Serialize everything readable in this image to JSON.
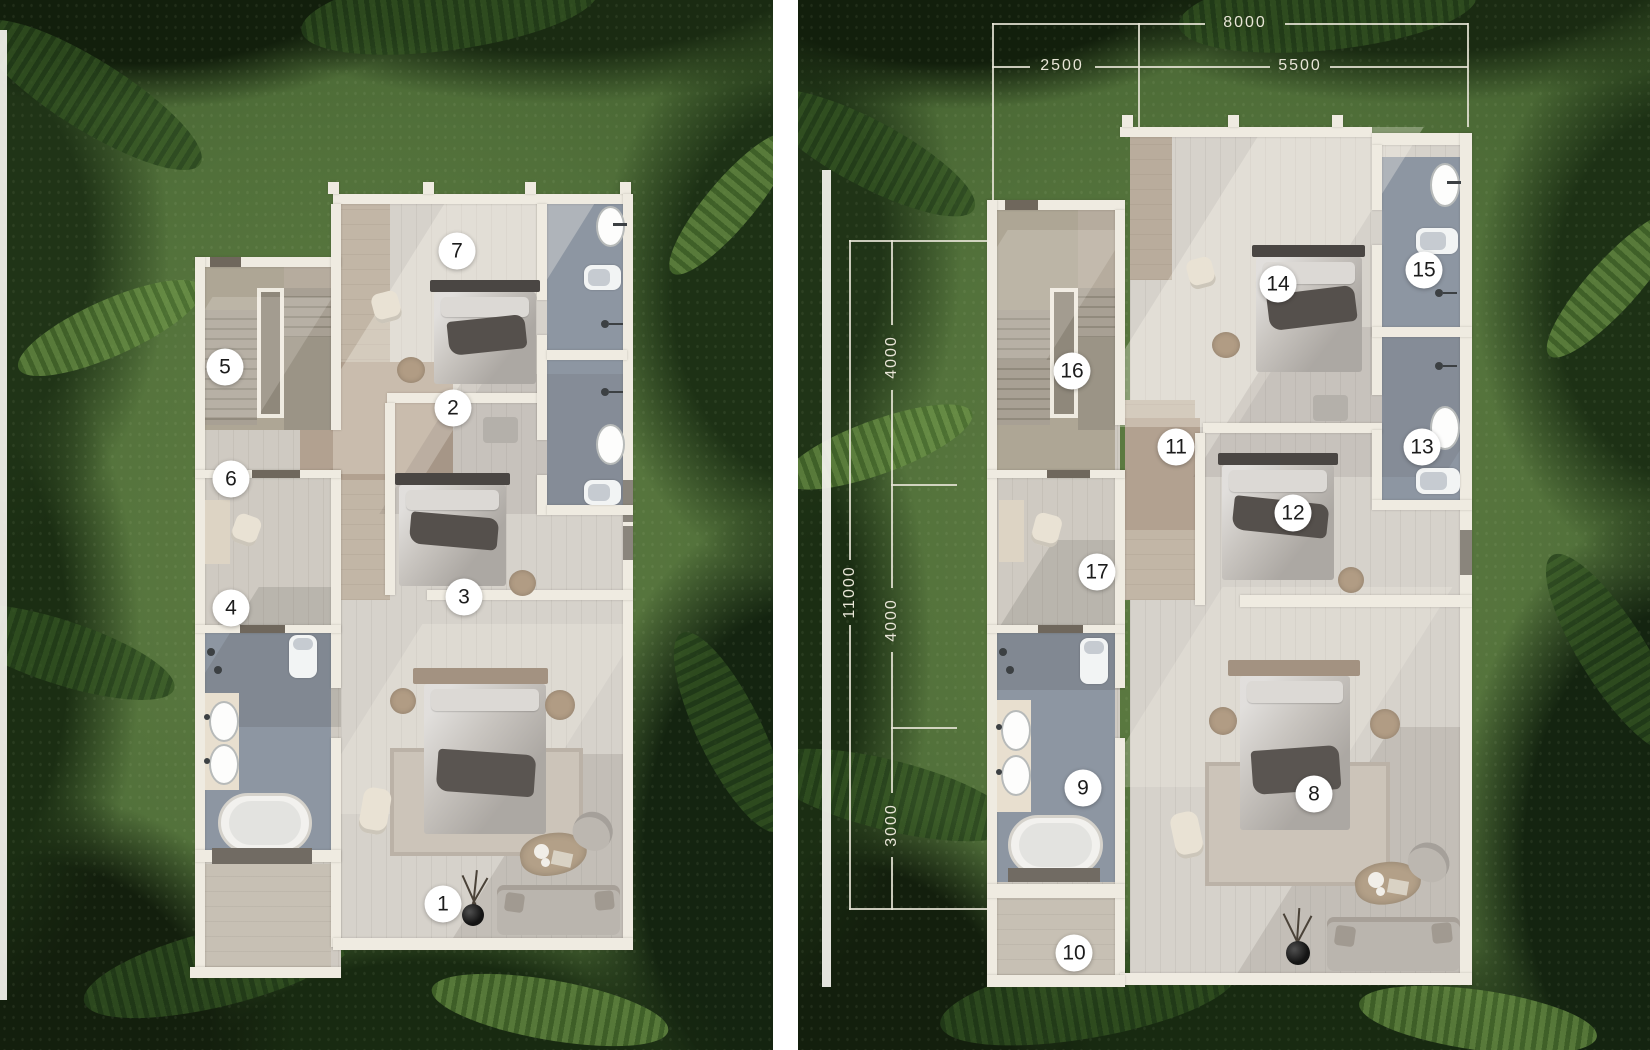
{
  "title": "Villa floor plan collage, two annotated plans on tropical garden background",
  "markers": [
    {
      "label": "1",
      "x": 443,
      "y": 904
    },
    {
      "label": "2",
      "x": 453,
      "y": 408
    },
    {
      "label": "3",
      "x": 464,
      "y": 597
    },
    {
      "label": "4",
      "x": 231,
      "y": 608
    },
    {
      "label": "5",
      "x": 225,
      "y": 367
    },
    {
      "label": "6",
      "x": 231,
      "y": 479
    },
    {
      "label": "7",
      "x": 457,
      "y": 251
    },
    {
      "label": "8",
      "x": 1314,
      "y": 794
    },
    {
      "label": "9",
      "x": 1083,
      "y": 788
    },
    {
      "label": "10",
      "x": 1074,
      "y": 953
    },
    {
      "label": "11",
      "x": 1176,
      "y": 447
    },
    {
      "label": "12",
      "x": 1293,
      "y": 513
    },
    {
      "label": "13",
      "x": 1422,
      "y": 447
    },
    {
      "label": "14",
      "x": 1278,
      "y": 284
    },
    {
      "label": "15",
      "x": 1424,
      "y": 270
    },
    {
      "label": "16",
      "x": 1072,
      "y": 371
    },
    {
      "label": "17",
      "x": 1097,
      "y": 572
    }
  ],
  "dimensions": {
    "top": {
      "total": "8000",
      "segments": [
        {
          "label": "2500"
        },
        {
          "label": "5500"
        }
      ]
    },
    "side": {
      "total": "11000",
      "segments": [
        {
          "label": "4000"
        },
        {
          "label": "4000"
        },
        {
          "label": "3000"
        }
      ]
    }
  },
  "colors": {
    "grass": "#51703a",
    "foliage_dark": "#1a2b12",
    "wall": "#efebe1",
    "floor_wood": "#d6d2cb",
    "floor_hall_tan": "#b2a190",
    "floor_bath_slate": "#8d96a2",
    "marker_bg": "#ffffff",
    "marker_text": "#1c1c1c",
    "dimension_text": "#e8e5d7"
  }
}
